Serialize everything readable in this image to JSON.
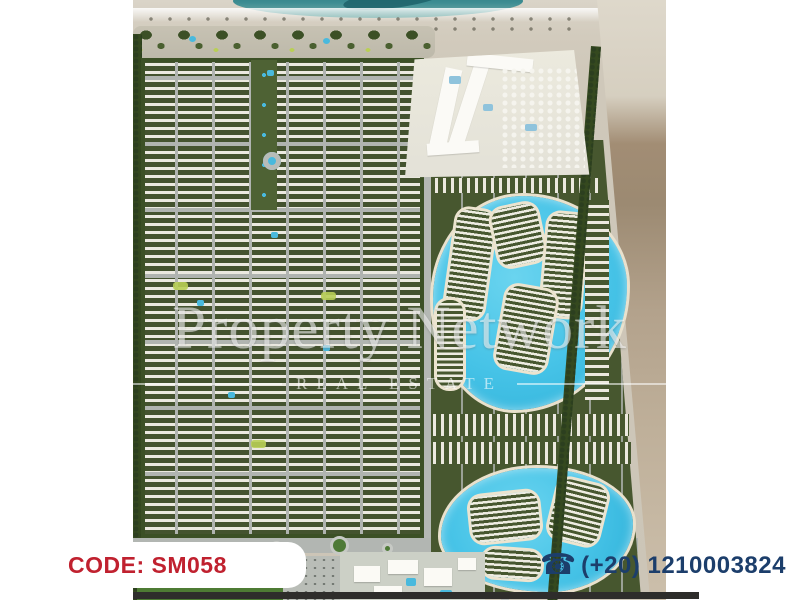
{
  "overlay": {
    "code_label": "CODE: SM058",
    "phone_number": "(+20) 1210003824",
    "phone_icon_glyph": "☎",
    "code_color": "#c0212f",
    "phone_color": "#1c3e6b"
  },
  "watermark": {
    "title": "Property Network",
    "subtitle": "REAL ESTATE"
  },
  "map": {
    "description": "aerial master plan render of a beachfront resort community",
    "regions": [
      {
        "name": "sea",
        "color": "#3d8d92"
      },
      {
        "name": "beach",
        "color": "#cfc8ba"
      },
      {
        "name": "beach-promenade",
        "color": "#bdb9aa"
      },
      {
        "name": "residential-district-west",
        "color": "#44532f"
      },
      {
        "name": "hotel-zone",
        "color": "#e7e5dd"
      },
      {
        "name": "lagoon-north",
        "color": "#46c3e7"
      },
      {
        "name": "lagoon-south",
        "color": "#46c3e7"
      },
      {
        "name": "desert",
        "color": "#a28d74"
      },
      {
        "name": "central-park-field",
        "color": "#4c7a33"
      },
      {
        "name": "amenity-buildings",
        "color": "#fbfaf5"
      }
    ]
  }
}
